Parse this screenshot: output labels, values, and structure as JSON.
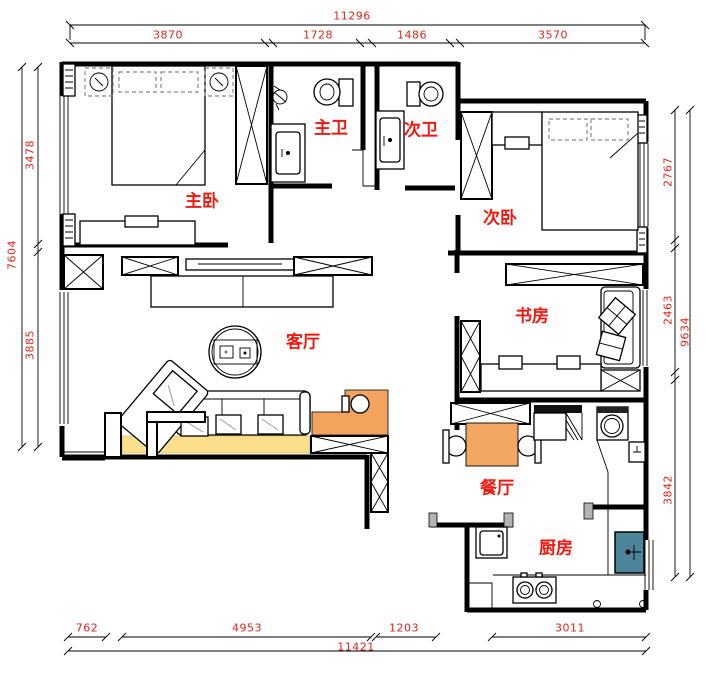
{
  "rooms": {
    "master_bedroom": "主卧",
    "master_bath": "主卫",
    "second_bath": "次卫",
    "second_bedroom": "次卧",
    "study": "书房",
    "living_room": "客厅",
    "dining_room": "餐厅",
    "kitchen": "厨房"
  },
  "dimensions": {
    "top_total": "11296",
    "top_1": "3870",
    "top_2": "1728",
    "top_3": "1486",
    "top_4": "3570",
    "left_total": "7604",
    "left_1": "3478",
    "left_2": "3885",
    "right_total": "9634",
    "right_1": "2767",
    "right_2": "2463",
    "right_3": "3842",
    "bottom_total": "11421",
    "bottom_1": "762",
    "bottom_2": "4953",
    "bottom_3": "1203",
    "bottom_4": "3011"
  },
  "colors": {
    "label_red": "#ee1a10",
    "dimension_red": "#e0251a",
    "rug_yellow": "#fbdf8d",
    "counter_orange": "#f2a45f",
    "dining_table_orange": "#f0a863",
    "sink_teal": "#4e8499",
    "wall_black": "#000000"
  }
}
